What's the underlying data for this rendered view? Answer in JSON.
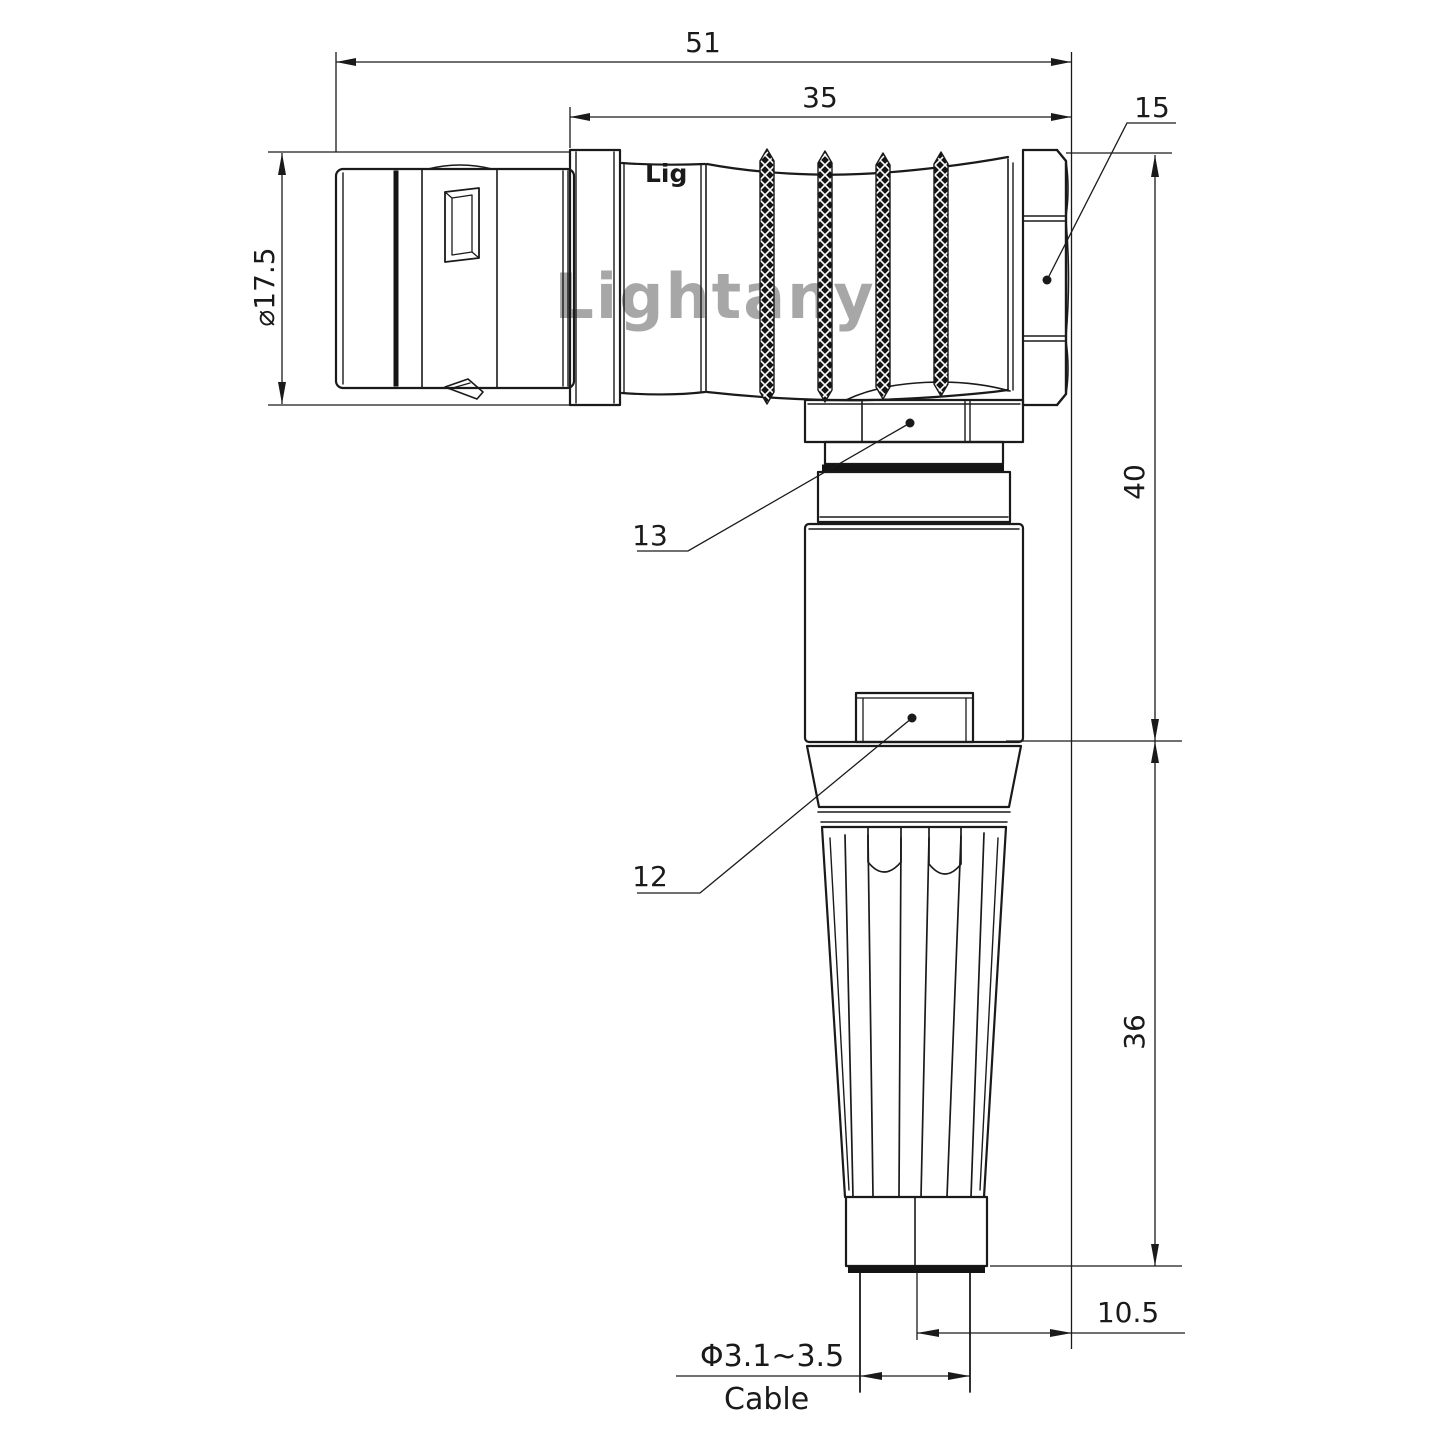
{
  "drawing": {
    "watermark": "Lightany",
    "body_logo_partial": "Lig",
    "dimensions": {
      "overall_length": {
        "value": "51"
      },
      "rear_length": {
        "value": "35"
      },
      "plug_diameter": {
        "value": "⌀17.5"
      },
      "elbow_height": {
        "value": "40"
      },
      "boot_height": {
        "value": "36"
      },
      "axis_offset": {
        "value": "10.5"
      },
      "cable_diameter": {
        "value": "Φ3.1~3.5"
      },
      "cable_label": "Cable"
    },
    "callouts": {
      "coupling_nut": "15",
      "hex_ring": "13",
      "latch": "12"
    },
    "colors": {
      "line": "#1a1a1a",
      "watermark": "#e08f8f"
    }
  }
}
